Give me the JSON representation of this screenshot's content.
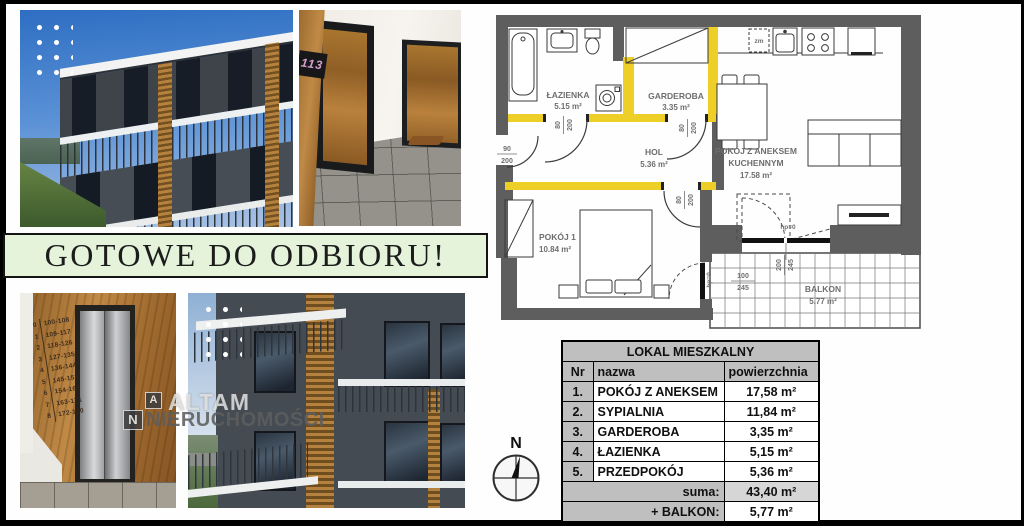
{
  "banner": {
    "text": "GOTOWE DO ODBIORU!"
  },
  "watermark": {
    "logo_a": "A",
    "logo_n": "N",
    "brand_top": "ALTAM",
    "brand_bottom": "NIERUCHOMOŚCI"
  },
  "compass": {
    "north": "N"
  },
  "colors": {
    "accent_yellow": "#EECF28",
    "wall_gray": "#5E5E5E",
    "banner_green": "#E4F3DA",
    "table_gray": "#BFBFBF"
  },
  "floorplan": {
    "rooms": {
      "lazienka": {
        "name": "ŁAZIENKA",
        "area": "5.15 m²"
      },
      "garderoba": {
        "name": "GARDEROBA",
        "area": "3.35 m²"
      },
      "hol": {
        "name": "HOL",
        "area": "5.36 m²"
      },
      "salon": {
        "name_line1": "POKÓJ Z ANEKSEM",
        "name_line2": "KUCHENNYM",
        "area": "17.58 m²"
      },
      "pokoj1": {
        "name": "POKÓJ 1",
        "area": "10.84 m²"
      },
      "balkon": {
        "name": "BALKON",
        "area": "5.77 m²"
      }
    },
    "dims": {
      "entrance": {
        "w": "90",
        "h": "200"
      },
      "bath_door": {
        "w": "80",
        "h": "200"
      },
      "garderoba_door": {
        "w": "80",
        "h": "200"
      },
      "pokoj_door": {
        "w": "80",
        "h": "200"
      },
      "balcony_window": {
        "w": "100",
        "h": "245"
      },
      "balcony_door": {
        "w": "200",
        "h": "245"
      },
      "hp_living": "hp=0",
      "hp_bedroom": "hp=0"
    },
    "labels": {
      "dishwasher": "zm"
    }
  },
  "table": {
    "title": "LOKAL MIESZKALNY",
    "headers": {
      "nr": "Nr",
      "name": "nazwa",
      "area": "powierzchnia"
    },
    "rows": [
      {
        "nr": "1.",
        "name": "POKÓJ Z ANEKSEM",
        "area": "17,58 m²"
      },
      {
        "nr": "2.",
        "name": "SYPIALNIA",
        "area": "11,84 m²"
      },
      {
        "nr": "3.",
        "name": "GARDEROBA",
        "area": "3,35 m²"
      },
      {
        "nr": "4.",
        "name": "ŁAZIENKA",
        "area": "5,15 m²"
      },
      {
        "nr": "5.",
        "name": "PRZEDPOKÓJ",
        "area": "5,36 m²"
      }
    ],
    "sum_label": "suma:",
    "sum_value": "43,40 m²",
    "balcony_label": "+ BALKON:",
    "balcony_value": "5,77 m²"
  },
  "photos": {
    "hallway": {
      "door_number": "113"
    },
    "elevator": {
      "floors": [
        {
          "level": "0",
          "range": "100-108"
        },
        {
          "level": "1",
          "range": "109-117"
        },
        {
          "level": "2",
          "range": "118-126"
        },
        {
          "level": "3",
          "range": "127-135"
        },
        {
          "level": "4",
          "range": "136-144"
        },
        {
          "level": "5",
          "range": "145-153"
        },
        {
          "level": "6",
          "range": "154-162"
        },
        {
          "level": "7",
          "range": "163-171"
        },
        {
          "level": "8",
          "range": "172-180"
        }
      ]
    }
  }
}
